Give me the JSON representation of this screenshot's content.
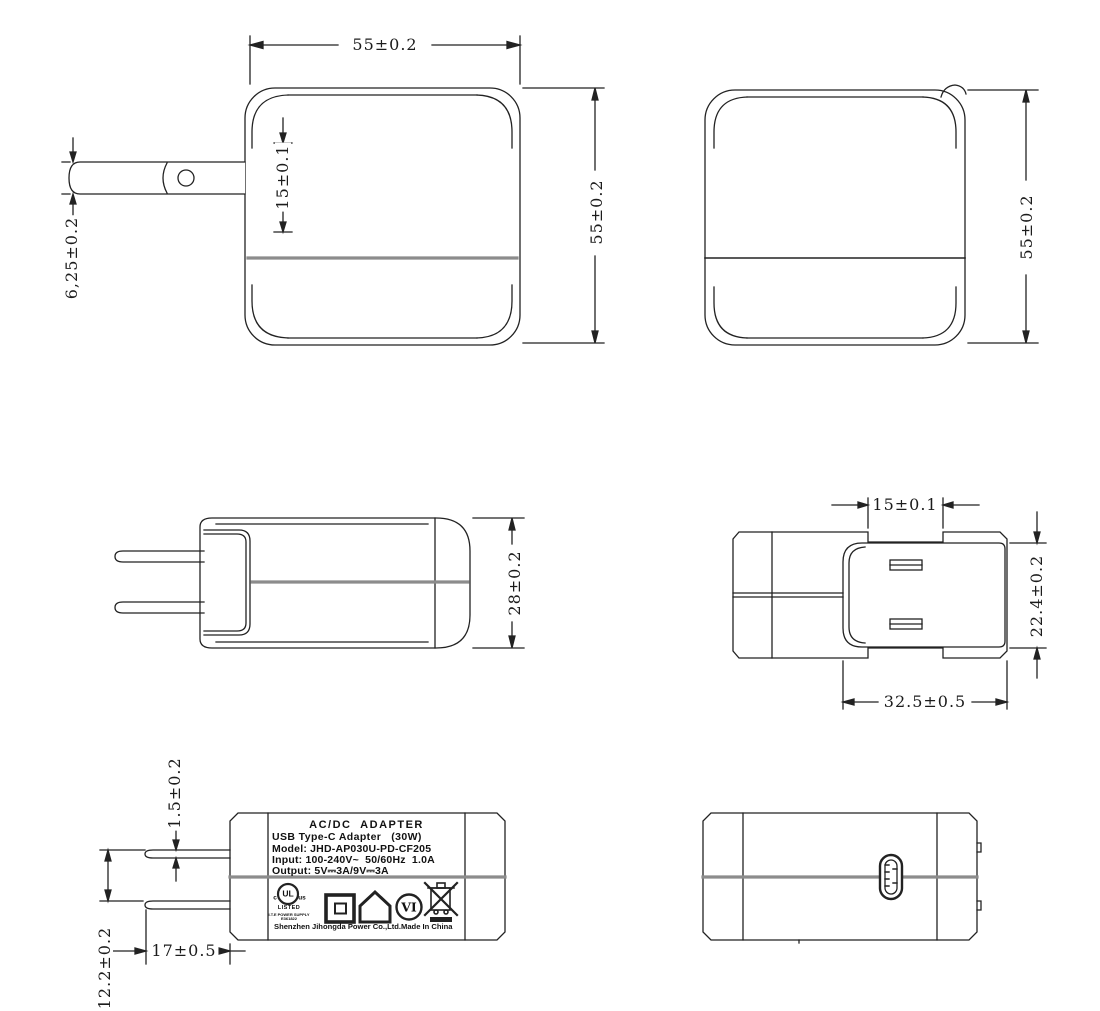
{
  "page": {
    "background": "#ffffff",
    "line_color": "#222222",
    "seam_color": "#8c8c8c"
  },
  "views": {
    "front": {
      "width_dim": "55±0.2",
      "height_dim": "55±0.2",
      "slot_dim": "15±0.1",
      "blade_dim": "6,25±0.2"
    },
    "rear": {
      "height_dim": "55±0.2"
    },
    "side": {
      "depth_dim": "28±0.2"
    },
    "top": {
      "blade_span_dim": "15±0.1",
      "platform_width_dim": "22.4±0.2",
      "platform_length_dim": "32.5±0.5"
    },
    "label_view": {
      "blade_thickness_dim": "1.5±0.2",
      "blade_gap_dim": "12.2±0.2",
      "blade_length_dim": "17±0.5"
    }
  },
  "label": {
    "title": "AC/DC  ADAPTER",
    "line2": "USB Type-C Adapter   (30W)",
    "line3": "Model: JHD-AP030U-PD-CF205",
    "line4": "Input: 100-240V~  50/60Hz  1.0A",
    "line5": "Output: 5V⎓3A/9V⎓3A",
    "ul_prefix": "c",
    "ul_monogram": "UL",
    "ul_suffix": "us",
    "ul_listed": "LISTED",
    "ul_category": "I.T.E POWER SUPPLY",
    "ul_file_no": "E361822",
    "efficiency_mark": "VI",
    "manufacturer": "Shenzhen Jihongda Power Co.,Ltd.",
    "origin": "Made In China"
  }
}
